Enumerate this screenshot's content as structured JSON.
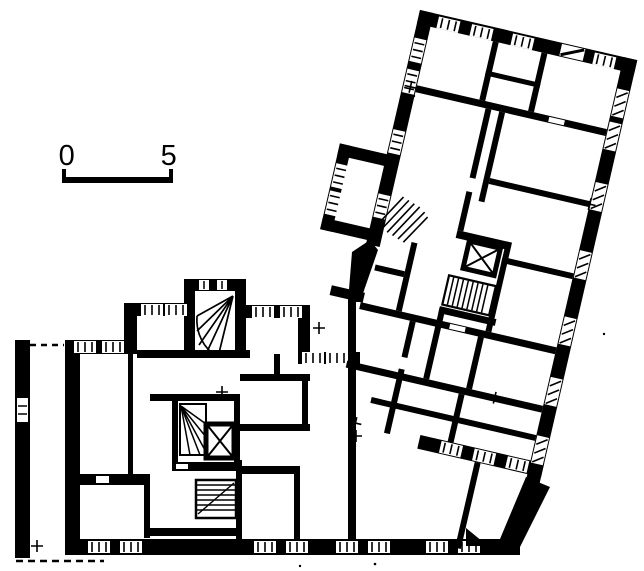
{
  "page": {
    "kind": "architectural-floor-plan",
    "description": "Black-and-white printed floor plan of an apartment building with two wings: an orthogonal lower-left wing and an upper-right wing rotated about 13 degrees, joined by a shared stair core zone.",
    "rotation_deg": 13
  },
  "colors": {
    "ink": "#000000",
    "paper": "#ffffff"
  },
  "scale_bar": {
    "start_label": "0",
    "end_label": "5"
  },
  "features": [
    "thick-poche-outer-walls",
    "window-slits-with-glazing-ticks",
    "hatched-window-openings",
    "elevator-shaft-x-symbol",
    "straight-stair-treads",
    "winder-stair-fan",
    "balcony-dashed-lines",
    "chimney-flue-symbol",
    "entrance-triangle-marker"
  ]
}
